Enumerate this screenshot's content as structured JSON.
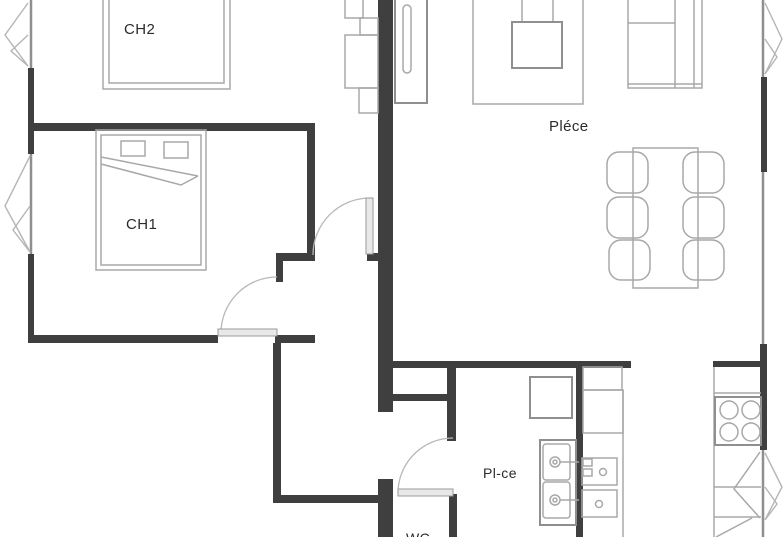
{
  "plan": {
    "rooms": {
      "ch2": {
        "label": "CH2"
      },
      "ch1": {
        "label": "CH1"
      },
      "living_room": {
        "label": "Pléce"
      },
      "kitchen": {
        "label": "Pl-ce"
      },
      "wc": {
        "label": "WC"
      }
    },
    "colors": {
      "wall": "#3f3f3f",
      "furniture_line": "#a8a8a8",
      "furniture_line_dark": "#8f8f8f",
      "door": "#b8b8b8",
      "window": "#8f8f8f",
      "text": "#2b2b2b",
      "background": "#ffffff"
    },
    "furniture_counts": {
      "beds": 2,
      "dining_chairs": 6,
      "stove_burners": 4,
      "sink_basins": 2
    }
  }
}
